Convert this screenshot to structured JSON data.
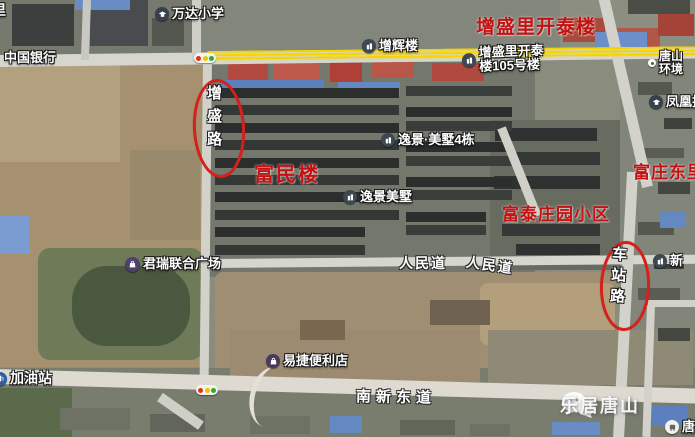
{
  "map": {
    "pois": {
      "corner_fragment": "里",
      "wanda_school": "万达小学",
      "bank_of_china": "中国银行",
      "zenghui_building": "增辉楼",
      "kaitai_105_line1": "增盛里开泰",
      "kaitai_105_line2": "楼105号楼",
      "tangshan_env_line1": "唐山",
      "tangshan_env_line2": "环境",
      "fenghuang_tech": "凤凰技",
      "yijing_meishu_4": "逸景·美墅4栋",
      "yijing_meishu": "逸景美墅",
      "junrui_plaza": "君瑞联合广场",
      "xin_building": "新",
      "yijie_store": "易捷便利店",
      "gas_station": "加油站",
      "tang_corner_poi": "唐"
    },
    "red_labels": {
      "kaitai_main": "增盛里开泰楼",
      "fumin": "富民楼",
      "fuzhuang_dongli": "富庄东里",
      "futai_estate": "富泰庄园小区"
    },
    "roads": {
      "zengsheng_road": "增盛路",
      "chezhan_road": "车站路",
      "renmin_1": "人民道",
      "renmin_2": "人民道",
      "nanxin_east": "南新东道"
    },
    "watermark": "乐居唐山",
    "colors": {
      "red_label": "#c41111",
      "route_yellow": "#f6d400",
      "marker_red": "#d6201b"
    }
  }
}
